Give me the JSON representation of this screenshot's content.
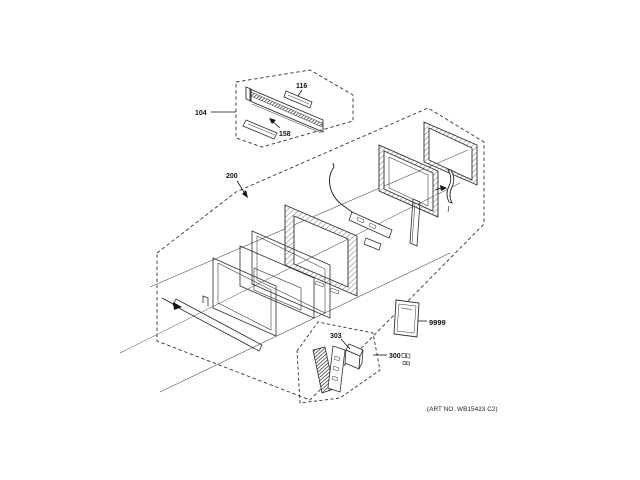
{
  "figure": {
    "type": "exploded-parts-diagram",
    "subject": "microwave-door-assembly",
    "callouts": {
      "c104": "104",
      "c116": "116",
      "c158": "158",
      "c200": "200",
      "c303": "303",
      "c300": "300",
      "c9999": "9999"
    },
    "footer_note": "(ART NO. WB15423 C2)",
    "colors": {
      "background": "#ffffff",
      "line": "#2e2e2e",
      "dashed_boundary": "#333333",
      "text": "#111111"
    }
  }
}
